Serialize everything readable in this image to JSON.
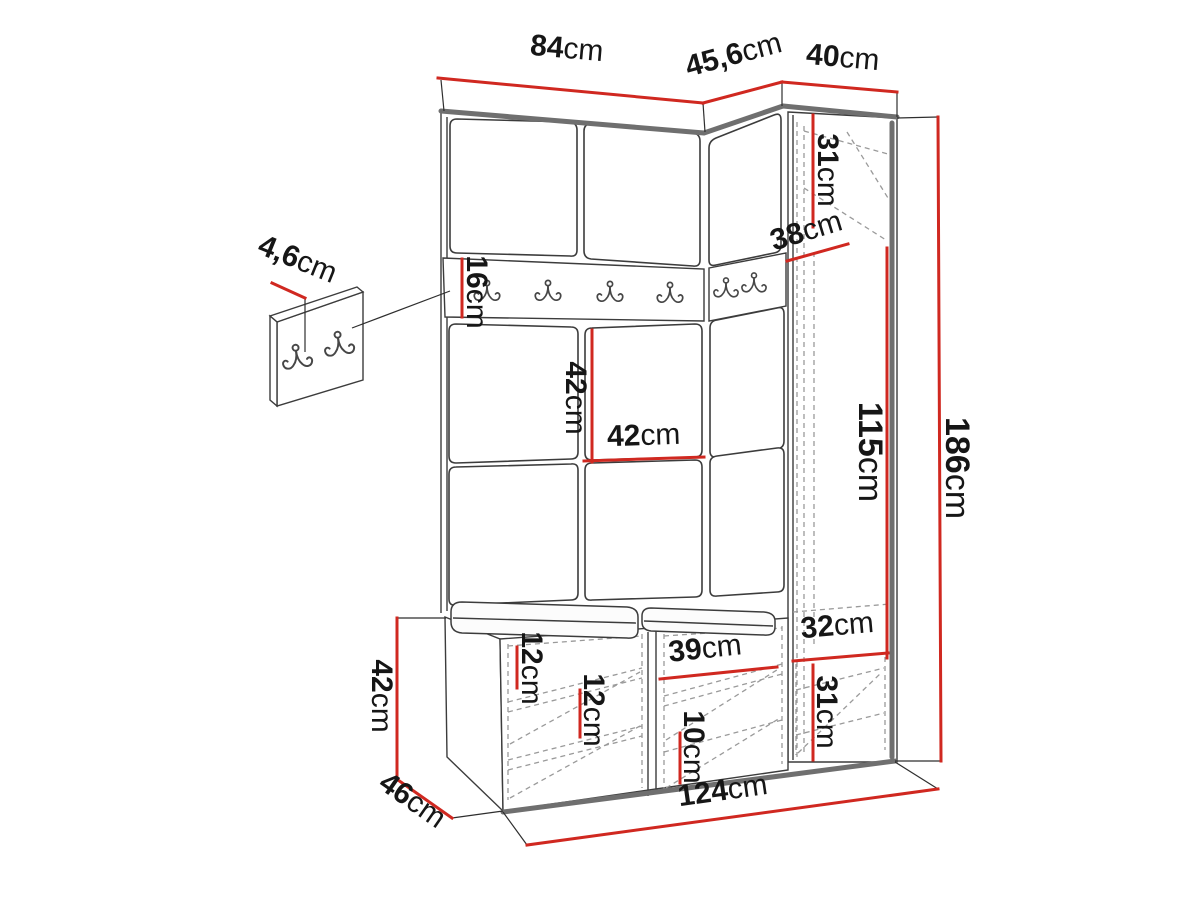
{
  "figure": {
    "type": "furniture dimension diagram",
    "subject": "hallway wardrobe set with coat-hook rail, corner cabinet and shoe bench",
    "unit": "cm",
    "accent_color": "#d02820",
    "line_color": "#3c3c3c",
    "background_color": "#ffffff",
    "rail_hook_count": 6,
    "wall_panel_hook_count": 2
  },
  "dimensions": {
    "top_left_width": {
      "value": "84",
      "unit": "cm"
    },
    "top_angled_width": {
      "value": "45,6",
      "unit": "cm"
    },
    "top_right_width": {
      "value": "40",
      "unit": "cm"
    },
    "hook_panel_depth": {
      "value": "4,6",
      "unit": "cm"
    },
    "rail_height": {
      "value": "16",
      "unit": "cm"
    },
    "cabinet_top_section": {
      "value": "31",
      "unit": "cm"
    },
    "cabinet_depth": {
      "value": "38",
      "unit": "cm"
    },
    "panel_height": {
      "value": "42",
      "unit": "cm"
    },
    "panel_width": {
      "value": "42",
      "unit": "cm"
    },
    "middle_section": {
      "value": "115",
      "unit": "cm"
    },
    "total_height": {
      "value": "186",
      "unit": "cm"
    },
    "bench_height": {
      "value": "42",
      "unit": "cm"
    },
    "bench_depth": {
      "value": "46",
      "unit": "cm"
    },
    "cushion_height": {
      "value": "12",
      "unit": "cm"
    },
    "bench_shelf_gap": {
      "value": "12",
      "unit": "cm"
    },
    "compartment_width": {
      "value": "39",
      "unit": "cm"
    },
    "bottom_shelf_gap": {
      "value": "10",
      "unit": "cm"
    },
    "cabinet_bottom_width": {
      "value": "32",
      "unit": "cm"
    },
    "cabinet_bottom_section": {
      "value": "31",
      "unit": "cm"
    },
    "total_width": {
      "value": "124",
      "unit": "cm"
    }
  }
}
